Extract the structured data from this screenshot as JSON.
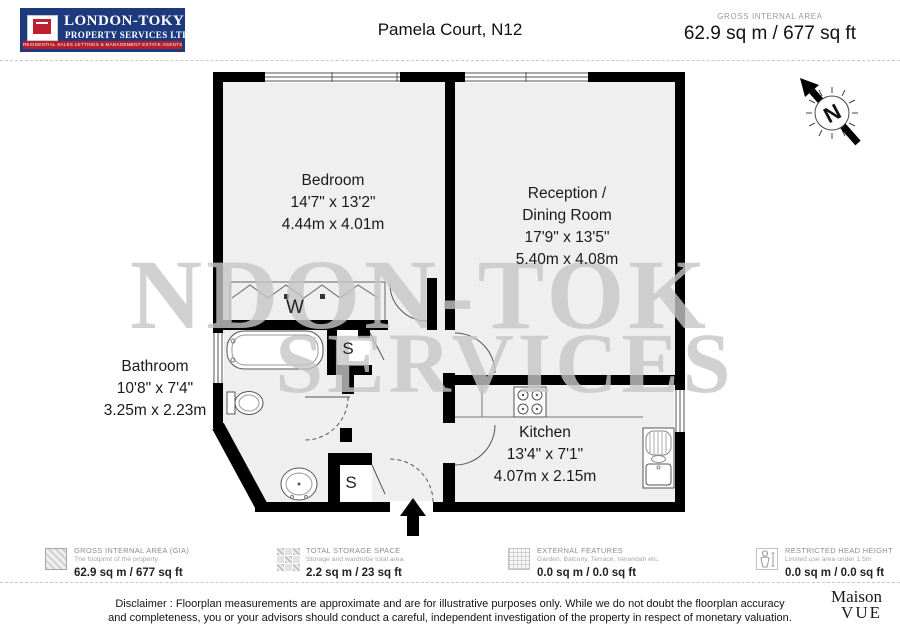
{
  "header": {
    "logo": {
      "name_line1": "LONDON-TOKYO",
      "name_line2": "PROPERTY SERVICES LTD.",
      "tagline": "RESIDENTIAL SALES  LETTINGS & MANAGEMENT  ESTATE AGENTS EST 1987"
    },
    "title": "Pamela Court, N12",
    "area_label": "GROSS INTERNAL AREA",
    "area_value": "62.9 sq m / 677 sq ft"
  },
  "plan": {
    "bedroom": {
      "name": "Bedroom",
      "imperial": "14'7\" x 13'2\"",
      "metric": "4.44m x 4.01m"
    },
    "reception": {
      "name": "Reception / Dining Room",
      "imperial": "17'9\" x 13'5\"",
      "metric": "5.40m x 4.08m"
    },
    "bathroom": {
      "name": "Bathroom",
      "imperial": "10'8\" x 7'4\"",
      "metric": "3.25m x 2.23m"
    },
    "kitchen": {
      "name": "Kitchen",
      "imperial": "13'4\" x 7'1\"",
      "metric": "4.07m x 2.15m"
    },
    "wardrobe_label": "W",
    "storage_label_1": "S",
    "storage_label_2": "S",
    "compass_label": "N",
    "watermark_line1": "NDON-TOK",
    "watermark_line2": "SERVICES"
  },
  "legend": {
    "items": [
      {
        "icon": "hatched-square-icon",
        "title": "GROSS INTERNAL AREA (GIA)",
        "subtitle": "The footprint of the property",
        "value": "62.9 sq m / 677 sq ft"
      },
      {
        "icon": "storage-blocks-icon",
        "title": "TOTAL STORAGE SPACE",
        "subtitle": "Storage and wardrobe total area",
        "value": "2.2 sq m / 23 sq ft"
      },
      {
        "icon": "grid-square-icon",
        "title": "EXTERNAL FEATURES",
        "subtitle": "Garden, Balcony, Terrace, Verandah etc.",
        "value": "0.0 sq m / 0.0 sq ft"
      },
      {
        "icon": "person-height-icon",
        "title": "RESTRICTED HEAD HEIGHT",
        "subtitle": "Limited use area under 1.5m",
        "value": "0.0 sq m / 0.0 sq ft"
      }
    ]
  },
  "footer": {
    "disclaimer_line1": "Disclaimer : Floorplan measurements are approximate and are for illustrative purposes only. While we do not doubt the floorplan accuracy",
    "disclaimer_line2": "and completeness, you or your advisors should conduct a careful, independent investigation of the property in respect of monetary valuation.",
    "brand_line1": "Maison",
    "brand_line2": "VUE"
  },
  "colors": {
    "logo_navy": "#1e3a7e",
    "logo_red": "#b51f2b",
    "wall_black": "#000000",
    "floor_gray": "#efefef",
    "watermark_gray": "#c6c6c6"
  }
}
